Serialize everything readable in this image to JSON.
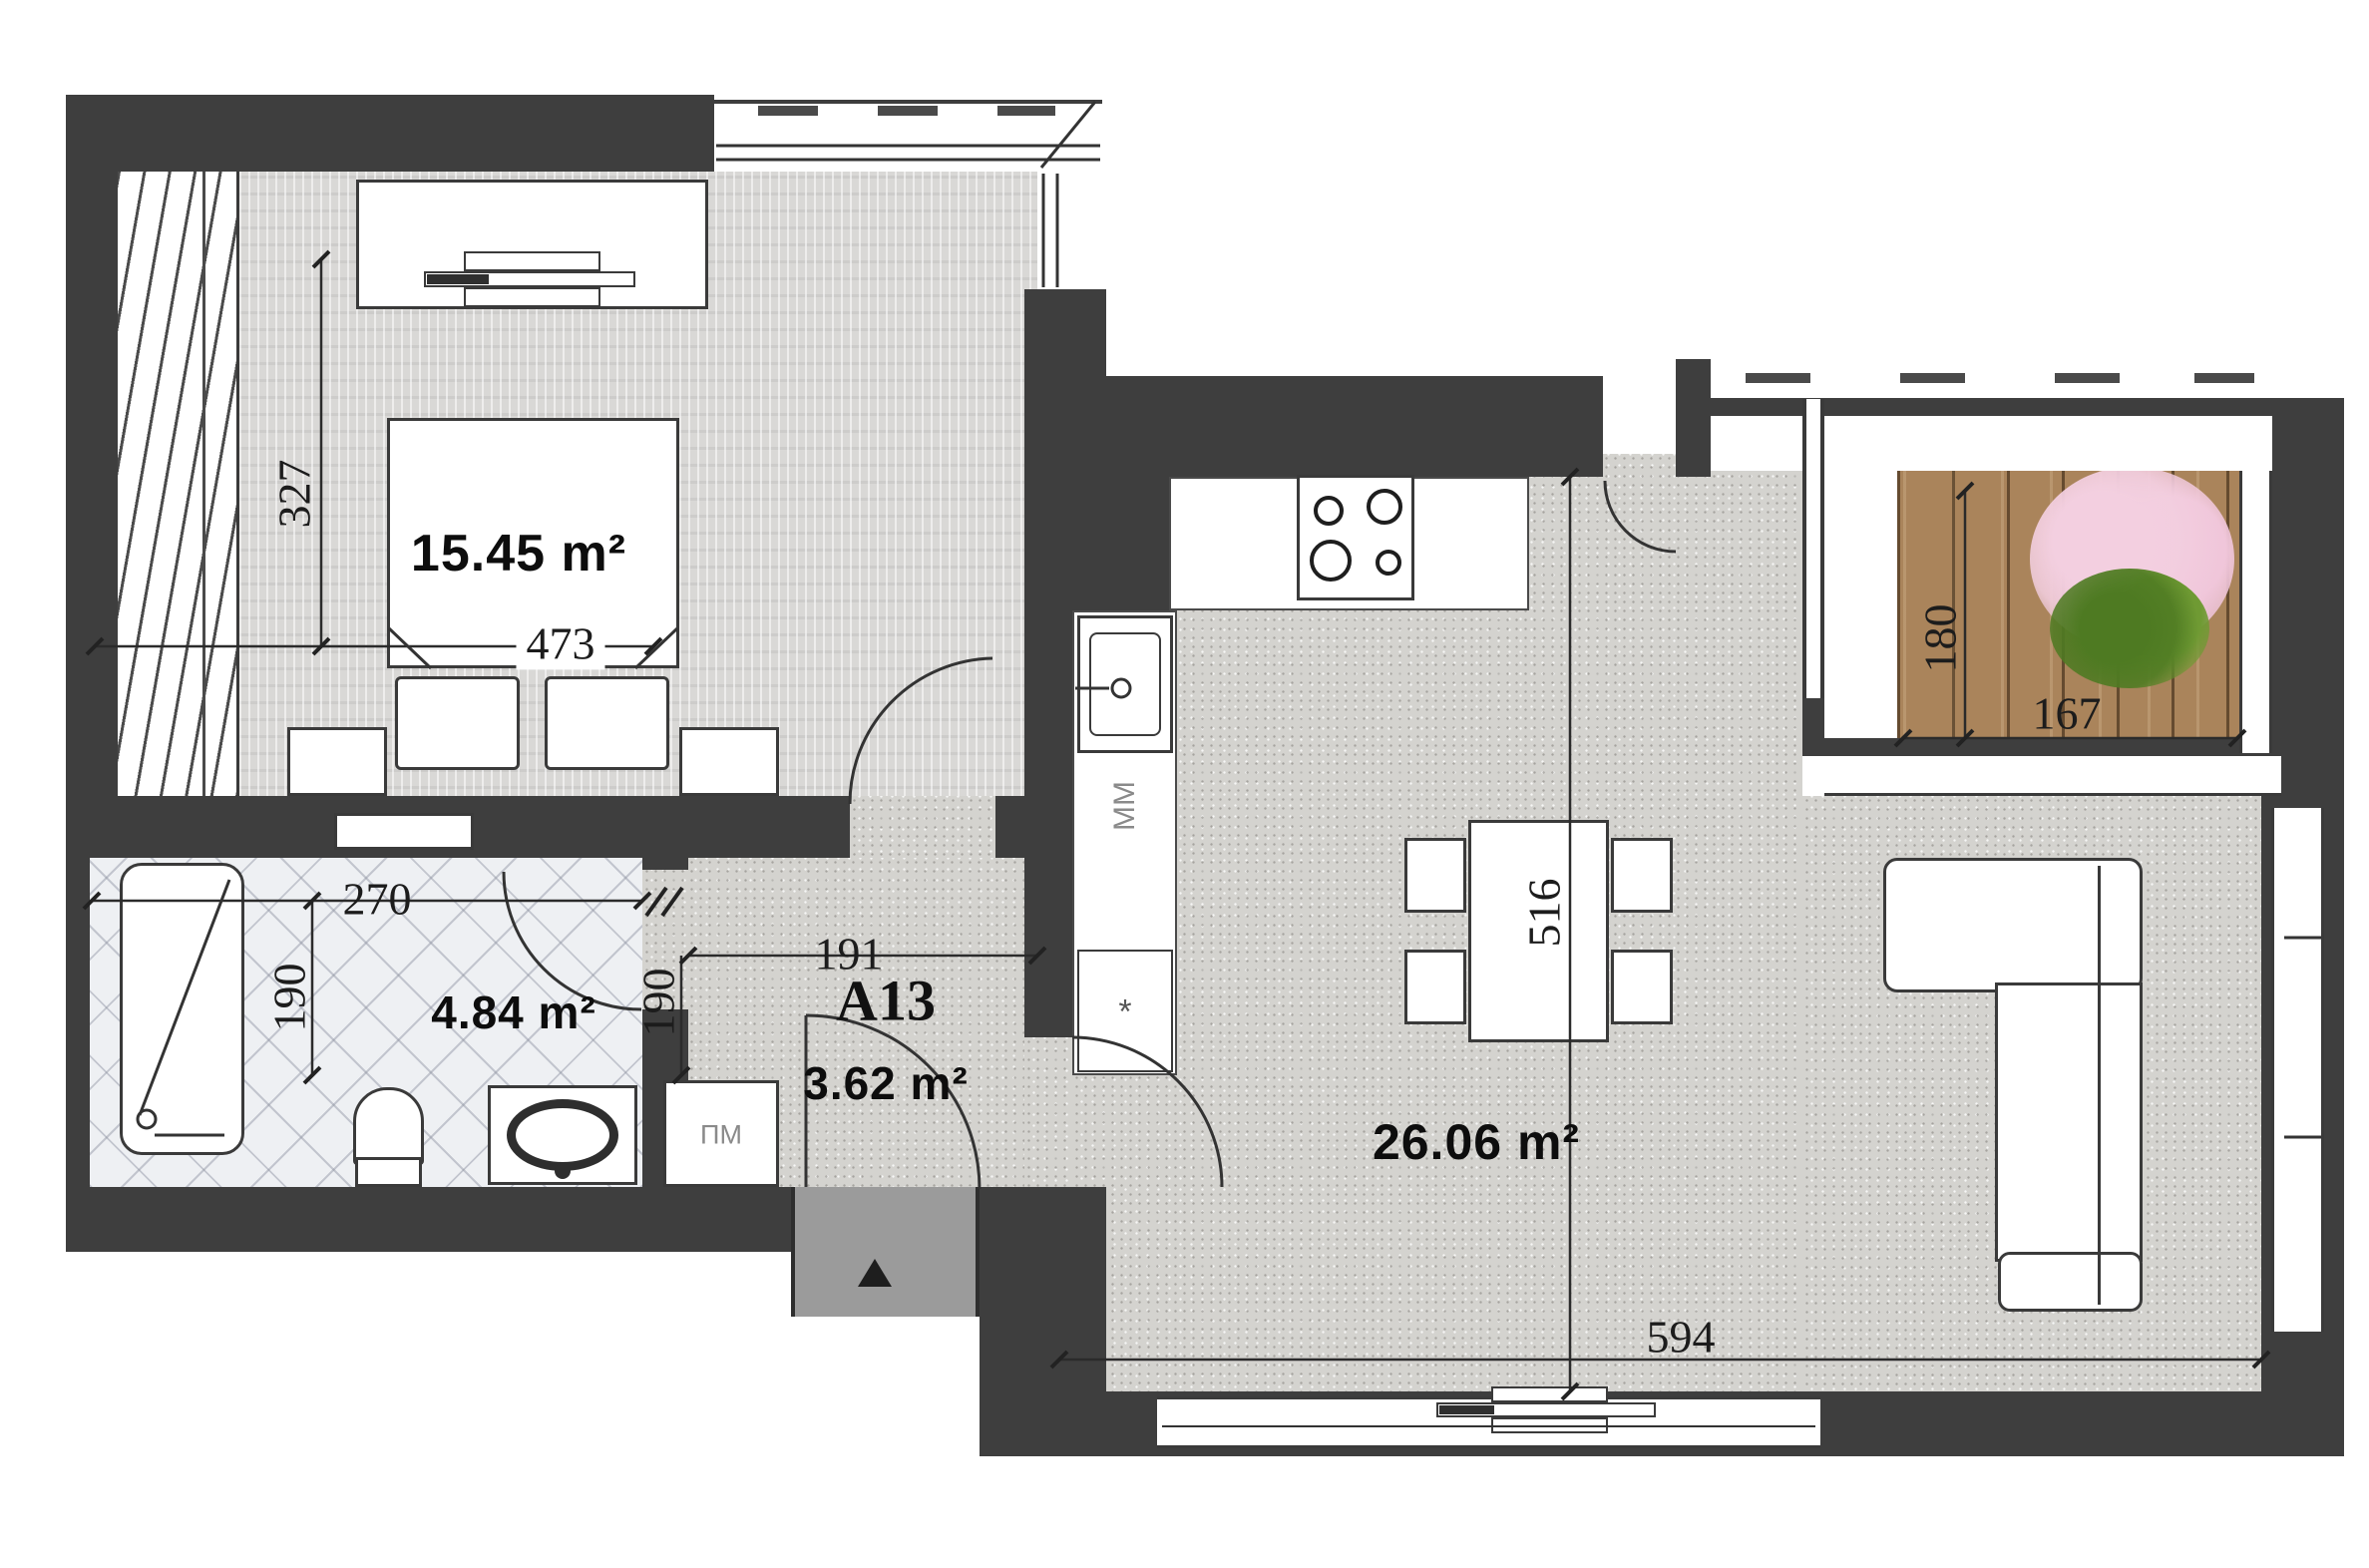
{
  "plan": {
    "rooms": {
      "bedroom": {
        "area": "15.45 m²"
      },
      "bathroom": {
        "area": "4.84 m²"
      },
      "hallway": {
        "unit": "A13",
        "area": "3.62 m²"
      },
      "living": {
        "area": "26.06 m²"
      }
    },
    "dimensions": {
      "bedroom_height": "327",
      "bedroom_width": "473",
      "bathroom_width": "270",
      "bathroom_depth": "190",
      "hall_width": "191",
      "hall_depth": "190",
      "living_height": "516",
      "living_width": "594",
      "balcony_depth": "180",
      "balcony_width": "167"
    },
    "appliances": {
      "washing_machine": "ПМ",
      "dishwasher": "ММ",
      "star_unit": "*"
    },
    "colors": {
      "wall": "#3e3e3e",
      "floor_living": "#d4d3cf",
      "floor_bedroom": "#d9d8d6",
      "balcony_wood": "#aa845b",
      "entrance_landing": "#9b9b9b"
    }
  }
}
